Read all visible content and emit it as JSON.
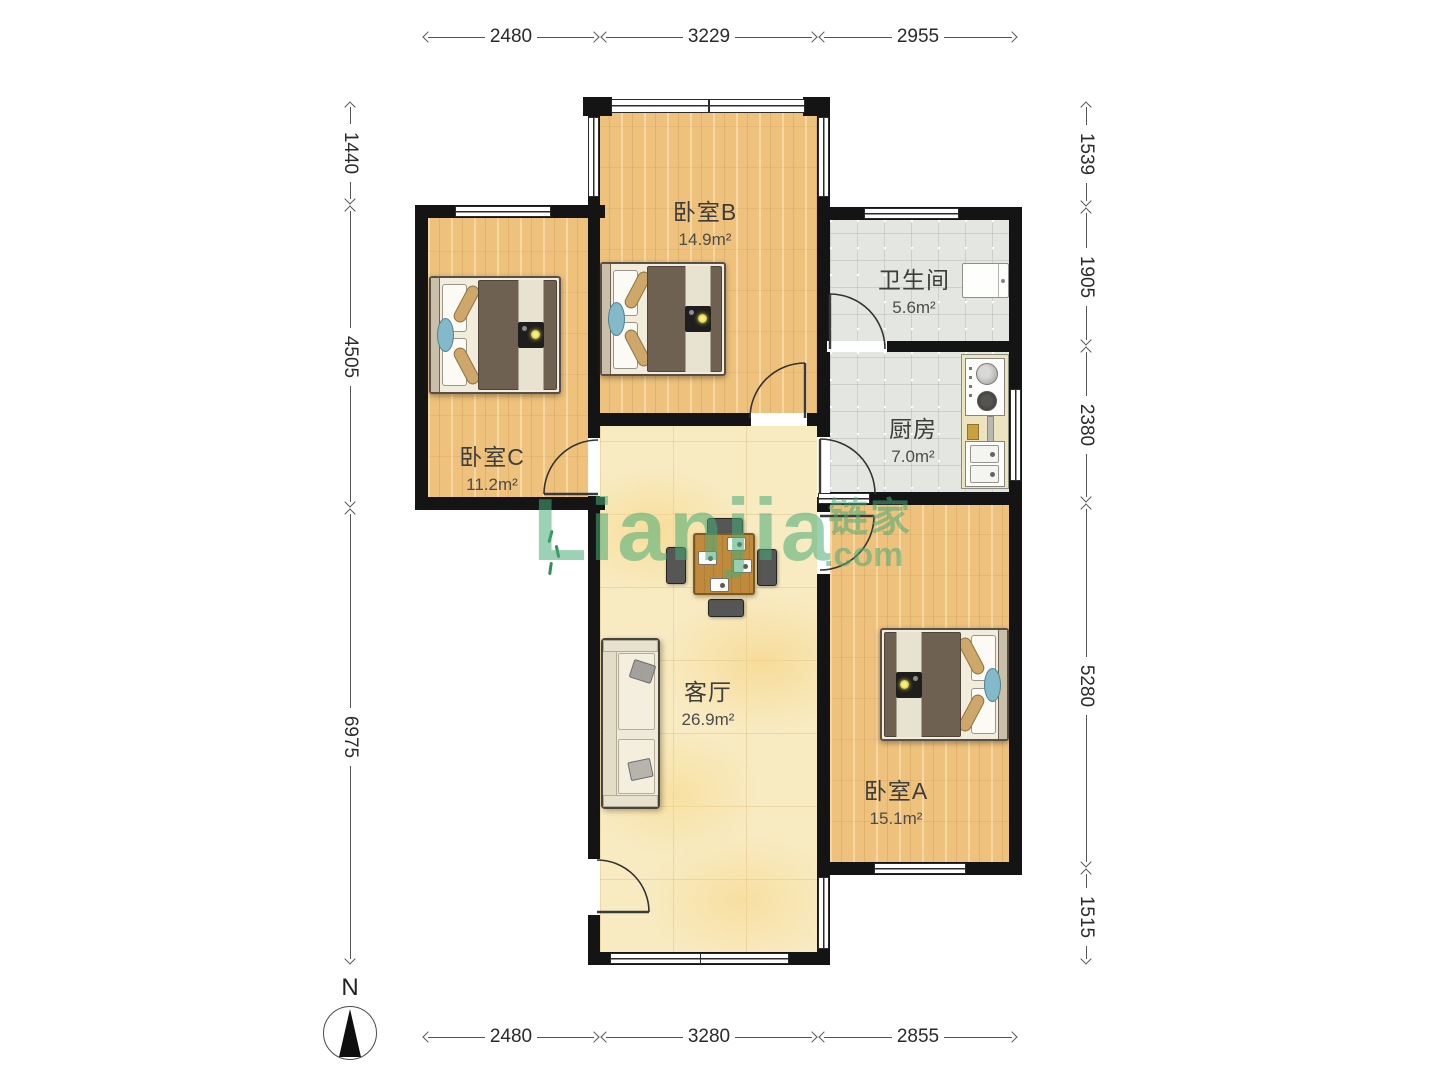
{
  "rooms": {
    "bedroom_b": {
      "name": "卧室B",
      "area": "14.9m²"
    },
    "bathroom": {
      "name": "卫生间",
      "area": "5.6m²"
    },
    "kitchen": {
      "name": "厨房",
      "area": "7.0m²"
    },
    "bedroom_c": {
      "name": "卧室C",
      "area": "11.2m²"
    },
    "living_room": {
      "name": "客厅",
      "area": "26.9m²"
    },
    "bedroom_a": {
      "name": "卧室A",
      "area": "15.1m²"
    }
  },
  "dimensions": {
    "top": [
      "2480",
      "3229",
      "2955"
    ],
    "bottom": [
      "2480",
      "3280",
      "2855"
    ],
    "left": [
      "1440",
      "4505",
      "6975"
    ],
    "right": [
      "1539",
      "1905",
      "2380",
      "5280",
      "1515"
    ]
  },
  "compass": {
    "label": "N"
  },
  "watermark": {
    "latin": "Lianjia",
    "cn": "链家",
    "cn_suffix": ".com"
  },
  "colors": {
    "wall": "#141414",
    "wood_floor": "#eec27d",
    "living_floor": "#f8ebc2",
    "tile_floor": "#e4e6e2",
    "watermark_green": "#48ac76"
  }
}
